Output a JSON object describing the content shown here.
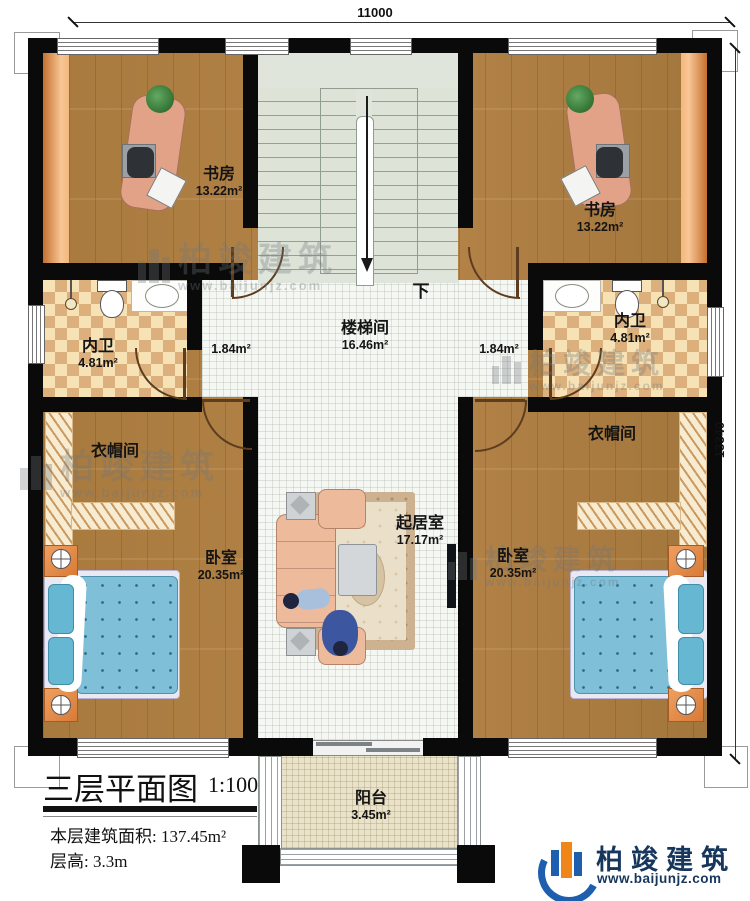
{
  "dimensions": {
    "top": "11000",
    "right": "13340"
  },
  "rooms": {
    "study_left": {
      "name": "书房",
      "area": "13.22m²"
    },
    "study_right": {
      "name": "书房",
      "area": "13.22m²"
    },
    "stairwell": {
      "name": "楼梯间",
      "area": "16.46m²"
    },
    "corridor_left": {
      "area": "1.84m²"
    },
    "corridor_right": {
      "area": "1.84m²"
    },
    "bath_left": {
      "name": "内卫",
      "area": "4.81m²"
    },
    "bath_right": {
      "name": "内卫",
      "area": "4.81m²"
    },
    "cloak_left": {
      "name": "衣帽间"
    },
    "cloak_right": {
      "name": "衣帽间"
    },
    "bedroom_left": {
      "name": "卧室",
      "area": "20.35m²"
    },
    "bedroom_right": {
      "name": "卧室",
      "area": "20.35m²"
    },
    "living": {
      "name": "起居室",
      "area": "17.17m²"
    },
    "balcony": {
      "name": "阳台",
      "area": "3.45m²"
    }
  },
  "stairs": {
    "down_label": "下"
  },
  "title_block": {
    "title": "三层平面图",
    "scale": "1:100",
    "area_label": "本层建筑面积:",
    "area_value": "137.45m²",
    "height_label": "层高:",
    "height_value": "3.3m"
  },
  "brand": {
    "name": "柏竣建筑",
    "url": "www.baijunjz.com"
  },
  "watermark": {
    "name": "柏竣建筑",
    "url": "www.baijunjz.com"
  },
  "colors": {
    "wall": "#0a0a0a",
    "wood_floor": "#a87c42",
    "tile_floor": "#f5f7f2",
    "bath_tile": "#dcb07c",
    "accent_orange": "#e08b4e",
    "bed_blue": "#7fc3dc",
    "brand_blue": "#16365c",
    "brand_orange": "#f08519",
    "watermark_gray": "#868c92"
  }
}
